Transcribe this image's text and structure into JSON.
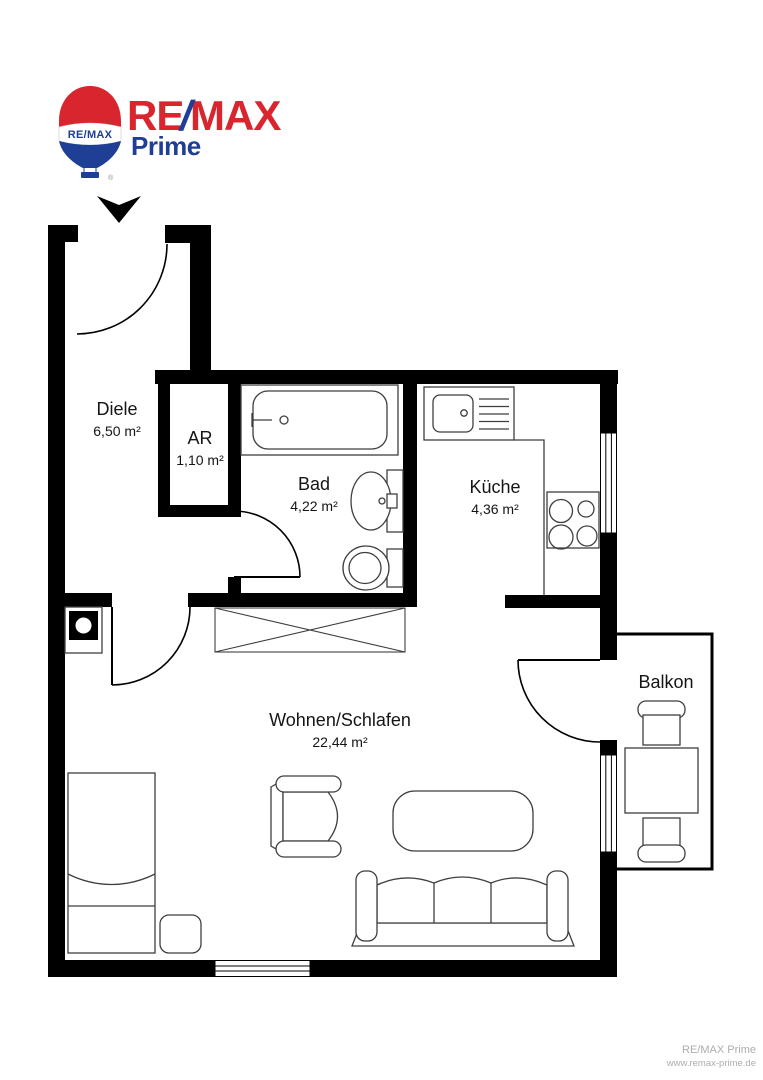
{
  "logo": {
    "wordmark": {
      "re": "RE",
      "slash": "/",
      "max": "MAX"
    },
    "subbrand": "Prime",
    "balloon_text": "RE/MAX",
    "registered_mark": "®",
    "colors": {
      "red": "#D9252D",
      "blue": "#1F3E96"
    }
  },
  "floorplan": {
    "rooms": [
      {
        "name": "Diele",
        "area": "6,50 m²"
      },
      {
        "name": "AR",
        "area": "1,10 m²"
      },
      {
        "name": "Bad",
        "area": "4,22 m²"
      },
      {
        "name": "Küche",
        "area": "4,36 m²"
      },
      {
        "name": "Wohnen/Schlafen",
        "area": "22,44 m²"
      },
      {
        "name": "Balkon",
        "area": ""
      }
    ],
    "icons": [
      "entrance-arrow",
      "door-swing",
      "window",
      "bathtub",
      "washbasin",
      "toilet",
      "kitchen-sink",
      "stove",
      "kitchen-counter",
      "wardrobe",
      "shaft",
      "bed",
      "nightstand",
      "armchair",
      "coffee-table",
      "sofa",
      "balcony-table",
      "balcony-chair"
    ],
    "colors": {
      "wall": "#000000",
      "furniture_line": "#3f3f3f"
    }
  },
  "watermark": {
    "line1": "RE/MAX Prime",
    "line2": "www.remax-prime.de"
  }
}
